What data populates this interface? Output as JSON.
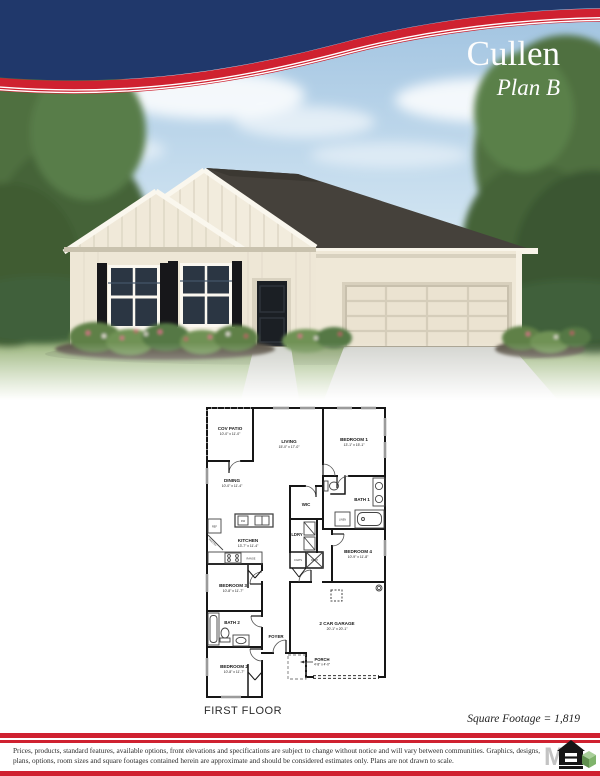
{
  "header": {
    "plan_name": "Cullen",
    "plan_variant": "Plan B"
  },
  "colors": {
    "navy": "#20386b",
    "red": "#cf2130",
    "wall_cream": "#f1ead9",
    "roof_gray": "#46423c"
  },
  "floor_plan": {
    "caption": "FIRST FLOOR",
    "square_footage": "Square Footage = 1,819",
    "rooms": [
      {
        "name": "COV PATIO",
        "dims": "10'-0\" x 11'-0\""
      },
      {
        "name": "LIVING",
        "dims": "15'-0\" x 17'-0\""
      },
      {
        "name": "BEDROOM 1",
        "dims": "13'-1\" x 15'-1\""
      },
      {
        "name": "DINING",
        "dims": "10'-0\" x 11'-4\""
      },
      {
        "name": "WIC"
      },
      {
        "name": "BATH 1"
      },
      {
        "name": "KITCHEN",
        "dims": "13'-7\" x 11'-4\""
      },
      {
        "name": "LDRY"
      },
      {
        "name": "BEDROOM 4",
        "dims": "10'-9\" x 11'-8\""
      },
      {
        "name": "BEDROOM 3",
        "dims": "10'-8\" x 11'-7\""
      },
      {
        "name": "BATH 2"
      },
      {
        "name": "FOYER"
      },
      {
        "name": "2 CAR GARAGE",
        "dims": "20'-1\" x 20'-1\""
      },
      {
        "name": "PORCH",
        "dims": "4'-8\" x 4'-0\""
      },
      {
        "name": "BEDROOM 2",
        "dims": "10'-8\" x 11'-7\""
      }
    ],
    "fixtures": {
      "ref": "REF",
      "pantry": "PANTRY",
      "range": "RANGE",
      "dw": "DW",
      "linen": "LINEN",
      "coats": "COATS",
      "mech": "MECH"
    }
  },
  "footer": {
    "disclaimer_line1": "Prices, products, standard features, available options, front elevations and specifications are subject to change without notice and will vary between communities.  Graphics, designs,",
    "disclaimer_line2": "plans, options, room sizes and square footages contained herein are approximate and should be considered estimates only.  Plans are not drawn to scale.",
    "logo_icon": "equal-housing-opportunity-logo"
  }
}
